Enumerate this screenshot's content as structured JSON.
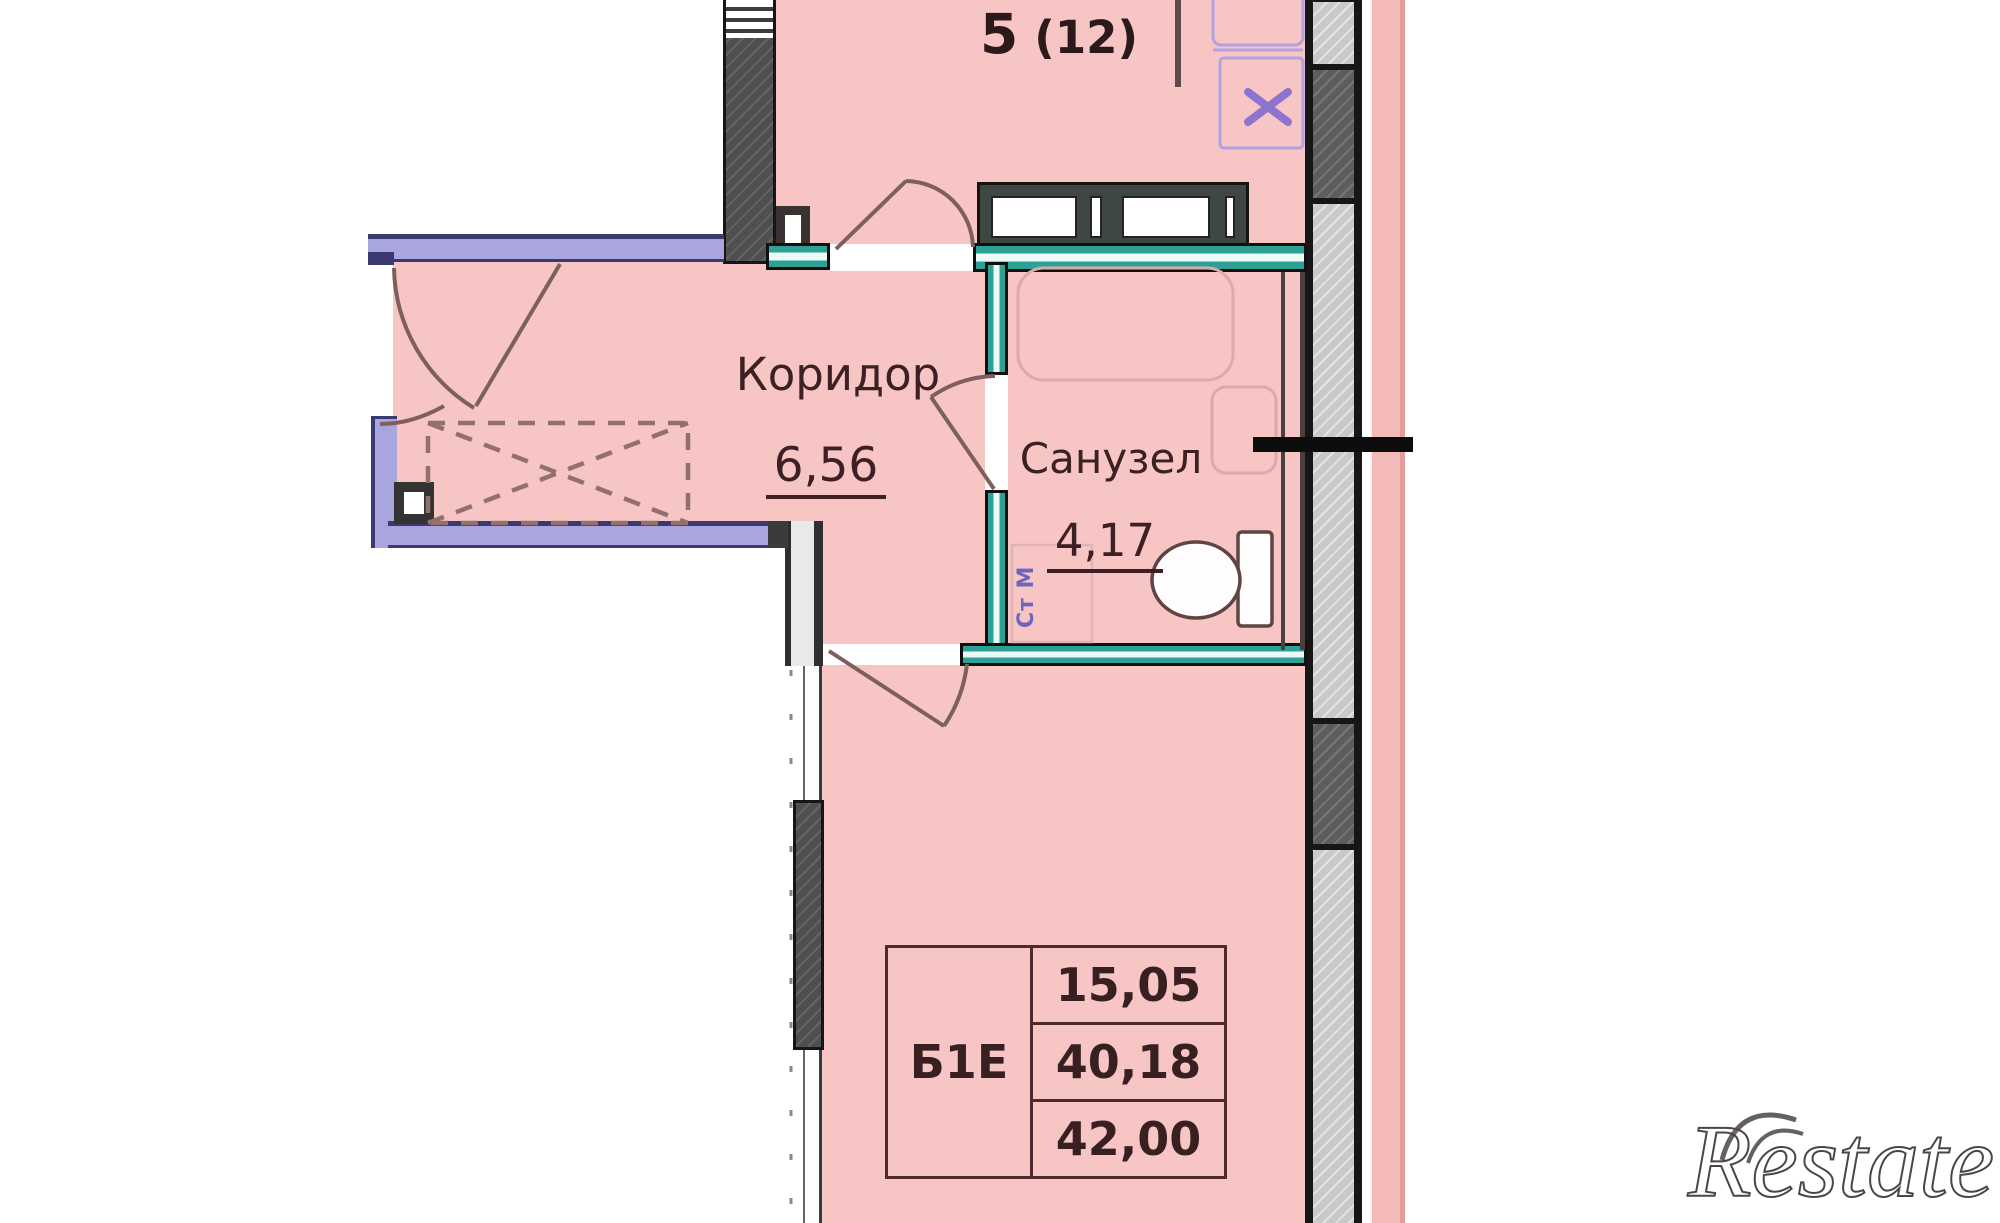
{
  "labels": {
    "apartment_number": "5",
    "apartment_number_alt": "(12)"
  },
  "rooms": {
    "corridor": {
      "name": "Коридор",
      "area": "6,56"
    },
    "bathroom": {
      "name": "Санузел",
      "area": "4,17"
    },
    "washing_machine_label": "Ст М"
  },
  "summary_table": {
    "unit_label": "Б1Е",
    "values": [
      "15,05",
      "40,18",
      "42,00"
    ]
  },
  "watermark": {
    "text": "Restate"
  },
  "colors": {
    "room_fill": "#f7c5c4",
    "facade_strip": "#f3bab9",
    "loggia_wall": "#a9a6dd",
    "loggia_wall_edge": "#3a3970",
    "wet_zone_wall": "#2ea096",
    "wall_dark": "#4f4f4f",
    "wall_segment_light": "#c9c9c9",
    "wall_segment_dark": "#5d5d5d",
    "text_dark": "#3c2023",
    "fixture_purple": "#b3a2e2",
    "washing_machine_purple": "#6f63c0",
    "watermark_gray": "#4b4644"
  }
}
